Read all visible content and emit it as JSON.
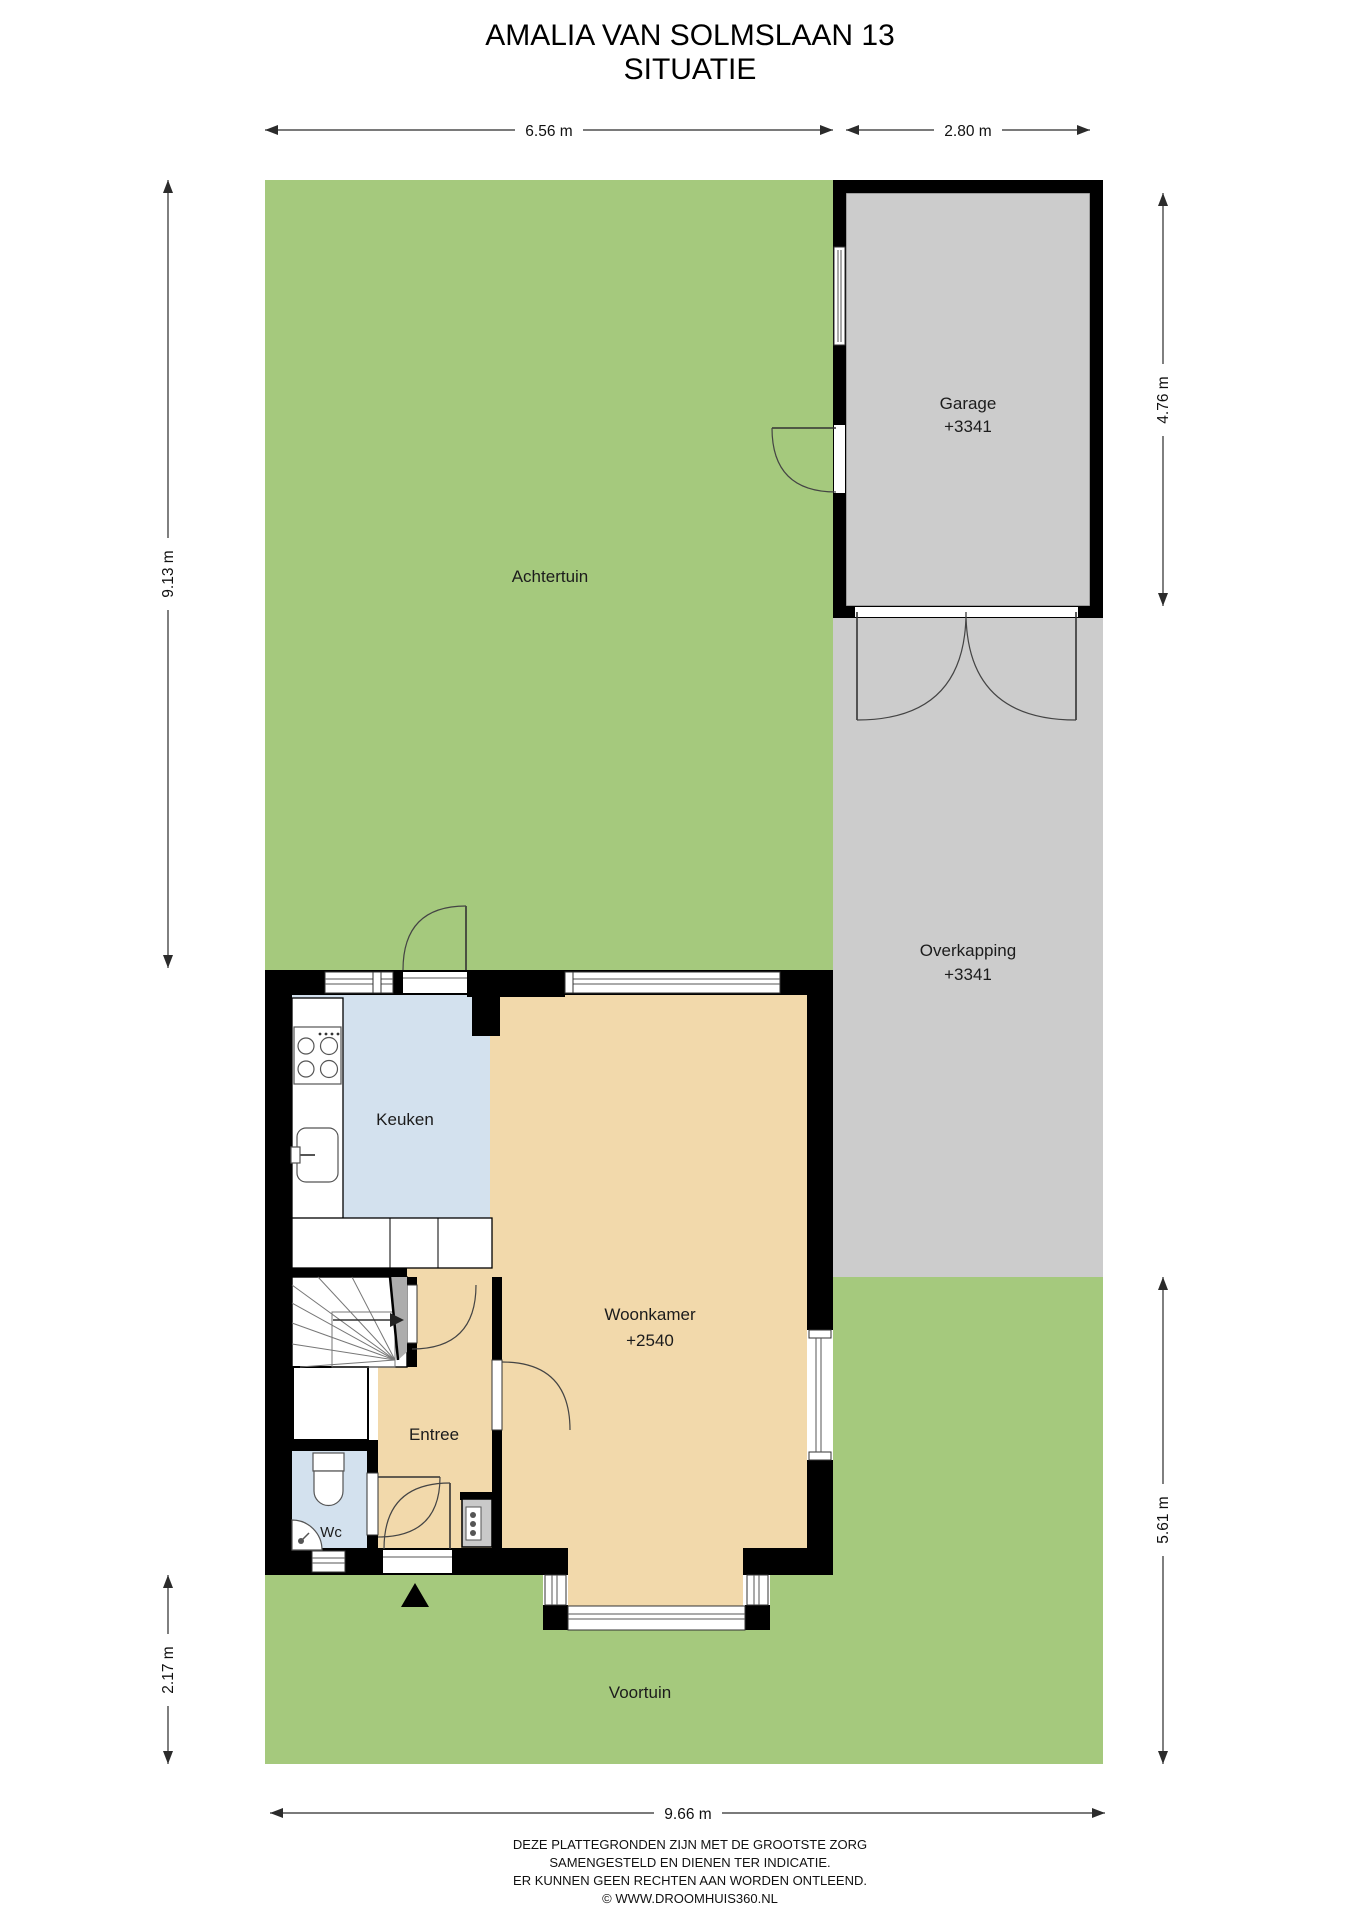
{
  "title": {
    "line1": "AMALIA VAN SOLMSLAAN 13",
    "line2": "SITUATIE"
  },
  "rooms": {
    "achtertuin": {
      "label": "Achtertuin"
    },
    "garage": {
      "label": "Garage",
      "level": "+3341"
    },
    "overkapping": {
      "label": "Overkapping",
      "level": "+3341"
    },
    "keuken": {
      "label": "Keuken"
    },
    "woonkamer": {
      "label": "Woonkamer",
      "level": "+2540"
    },
    "entree": {
      "label": "Entree"
    },
    "wc": {
      "label": "Wc"
    },
    "voortuin": {
      "label": "Voortuin"
    }
  },
  "dimensions": {
    "top_left": "6.56 m",
    "top_right": "2.80 m",
    "left_upper": "9.13 m",
    "left_lower": "2.17 m",
    "right_upper": "4.76 m",
    "right_lower": "5.61 m",
    "bottom": "9.66 m"
  },
  "footer": {
    "line1": "DEZE PLATTEGRONDEN ZIJN MET DE GROOTSTE ZORG",
    "line2": "SAMENGESTELD EN DIENEN TER INDICATIE.",
    "line3": "ER KUNNEN GEEN RECHTEN AAN WORDEN ONTLEEND.",
    "line4": "© WWW.DROOMHUIS360.NL"
  },
  "colors": {
    "garden": "#a5c97d",
    "paving": "#cccccc",
    "floor_main": "#f2d9ab",
    "floor_wet": "#d3e1ee",
    "wall": "#000000"
  }
}
